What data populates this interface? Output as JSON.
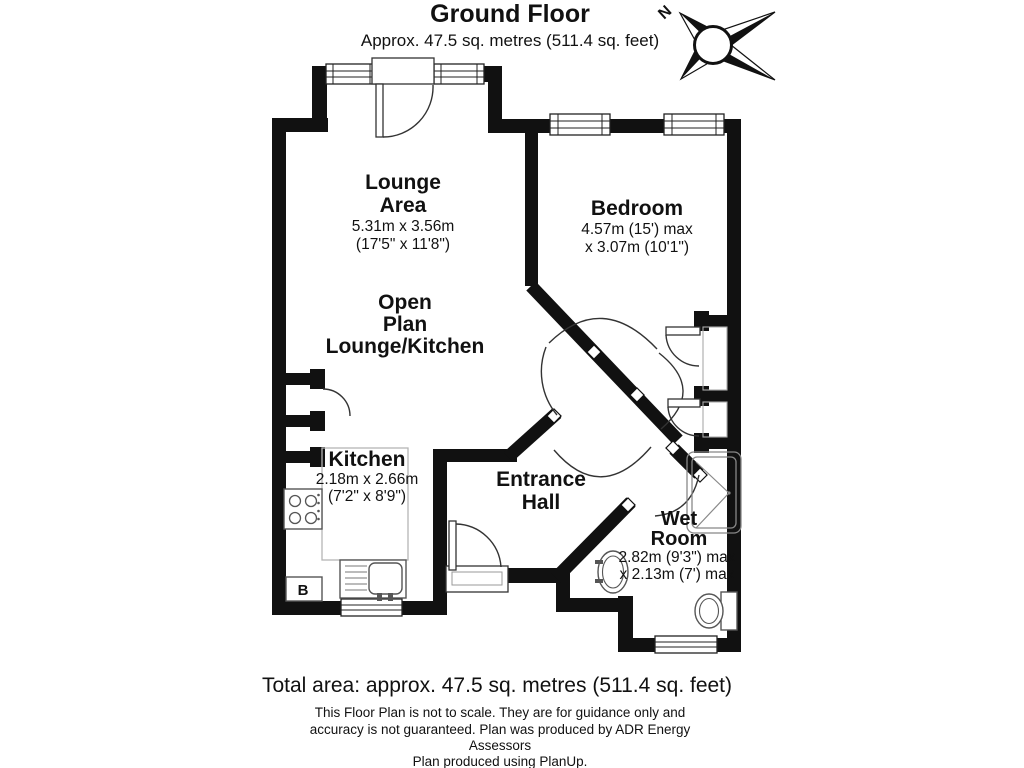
{
  "title": "Ground Floor",
  "subtitle": "Approx. 47.5 sq. metres (511.4 sq. feet)",
  "compass": {
    "north": "N"
  },
  "rooms": {
    "lounge": {
      "line1": "Lounge",
      "line2": "Area",
      "metric": "5.31m x 3.56m",
      "imperial": "(17'5\" x 11'8\")"
    },
    "open_plan": {
      "line1": "Open",
      "line2": "Plan",
      "line3": "Lounge/Kitchen"
    },
    "bedroom": {
      "name": "Bedroom",
      "dim1": "4.57m (15') max",
      "dim2": "x 3.07m (10'1\")"
    },
    "kitchen": {
      "name": "Kitchen",
      "metric": "2.18m x 2.66m",
      "imperial": "(7'2\" x 8'9\")"
    },
    "hall": {
      "line1": "Entrance",
      "line2": "Hall"
    },
    "wet_room": {
      "line1": "Wet",
      "line2": "Room",
      "dim1": "2.82m (9'3\") max",
      "dim2": "x 2.13m (7') max"
    }
  },
  "fixtures": {
    "boiler": "B"
  },
  "footer": {
    "total": "Total area: approx. 47.5 sq. metres (511.4 sq. feet)",
    "disc1": "This Floor Plan is not to scale. They are for guidance only and",
    "disc2": "accuracy is not guaranteed. Plan was produced by ADR Energy",
    "disc3": "Assessors",
    "disc4": "Plan produced using PlanUp."
  },
  "colors": {
    "wall": "#111111",
    "text": "#111111",
    "background": "#ffffff"
  }
}
